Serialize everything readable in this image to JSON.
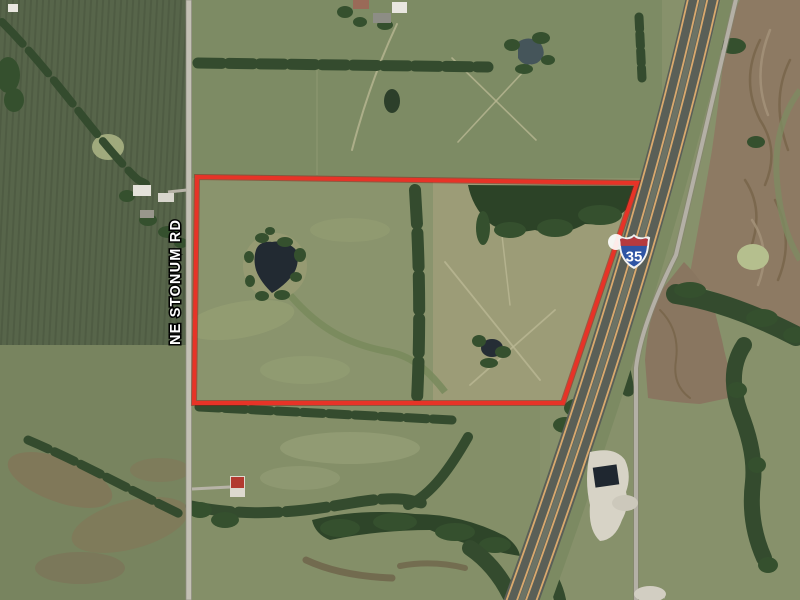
{
  "map": {
    "view": "satellite-aerial",
    "road_label": "NE STONUM RD",
    "shield": {
      "system": "Interstate",
      "number": "35"
    },
    "boundary": {
      "color": "#e73327",
      "points": [
        [
          197,
          177
        ],
        [
          637,
          183
        ],
        [
          563,
          403
        ],
        [
          194,
          403
        ]
      ]
    },
    "features": {
      "large_pond_center": [
        275,
        266
      ],
      "small_pond_center": [
        492,
        348
      ],
      "north_pond_center": [
        530,
        52
      ],
      "red_roof_barn": [
        237,
        486
      ],
      "gravel_pad": [
        608,
        495
      ],
      "highway_runs": "north-northeast to south-southwest",
      "frontage_road": "east of highway"
    },
    "colors": {
      "boundary_red": "#e73327",
      "shield_blue": "#2f55a4",
      "shield_red": "#b53a3e",
      "pond_water": "#222a32",
      "pasture_green": "#87916b",
      "crop_field_green": "#57654a",
      "plowed_brown": "#8d7a63",
      "tree_green": "#33492f",
      "highway_asphalt": "#5a5f57",
      "highway_stripe": "#d9a96e",
      "local_road_gray": "#c3c0b4"
    }
  }
}
